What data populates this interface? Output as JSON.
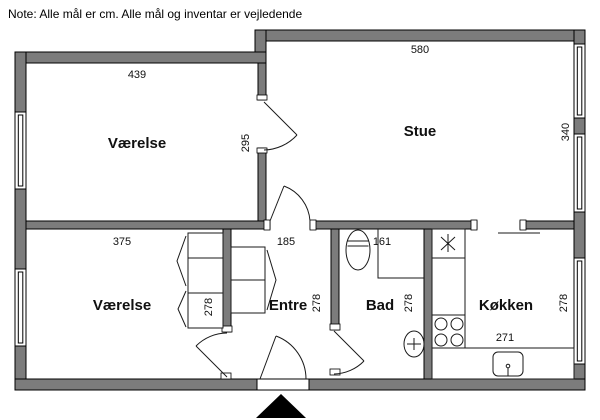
{
  "note": "Note: Alle mål er cm. Alle mål og inventar er vejledende",
  "rooms": {
    "vaerelse_top": {
      "label": "Værelse",
      "width_cm": "439",
      "depth_cm": "295"
    },
    "stue": {
      "label": "Stue",
      "width_cm": "580",
      "depth_cm": "340"
    },
    "vaerelse_bottom": {
      "label": "Værelse",
      "width_cm": "375",
      "depth_cm": "278"
    },
    "entre": {
      "label": "Entre",
      "width_cm": "185",
      "depth_cm": "278"
    },
    "bad": {
      "label": "Bad",
      "width_cm": "161",
      "depth_cm": "278"
    },
    "koekken": {
      "label": "Køkken",
      "width_cm": "271",
      "depth_cm": "278"
    }
  },
  "fixtures": {
    "bad": [
      "toilet",
      "shower-corner",
      "hand-basin"
    ],
    "koekken": [
      "refrigerator",
      "stove-4-burner",
      "kitchen-sink",
      "countertop"
    ],
    "vaerelse_bottom": [
      "wardrobe"
    ],
    "entre": [
      "wardrobe"
    ],
    "entrance": [
      "entrance-door",
      "entrance-arrow"
    ]
  },
  "colors": {
    "wall": "#7c7c7c",
    "outline": "#000000",
    "floor": "#ffffff",
    "fixture_line": "#1a1a1a",
    "entrance_marker": "#000000"
  }
}
